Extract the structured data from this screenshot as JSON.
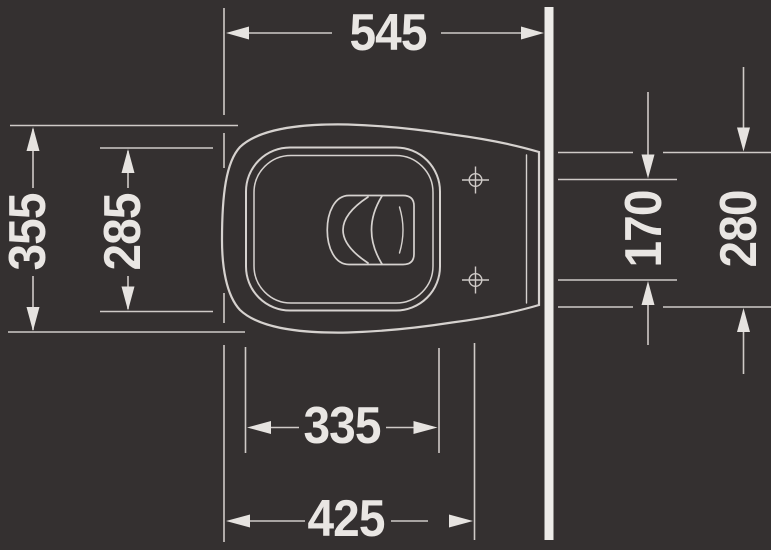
{
  "drawing": {
    "title": "wall-hung toilet top view dimension drawing",
    "dimensions": {
      "top": {
        "value": "545"
      },
      "left_outer": {
        "value": "355"
      },
      "left_inner": {
        "value": "285"
      },
      "right_inner": {
        "value": "170"
      },
      "right_outer": {
        "value": "280"
      },
      "bottom_inner": {
        "value": "335"
      },
      "bottom_outer": {
        "value": "425"
      }
    },
    "colors": {
      "background": "#343030",
      "line": "#d3cecb",
      "arrow_and_text": "#e9e6e3",
      "wall": "#edebe8"
    }
  }
}
